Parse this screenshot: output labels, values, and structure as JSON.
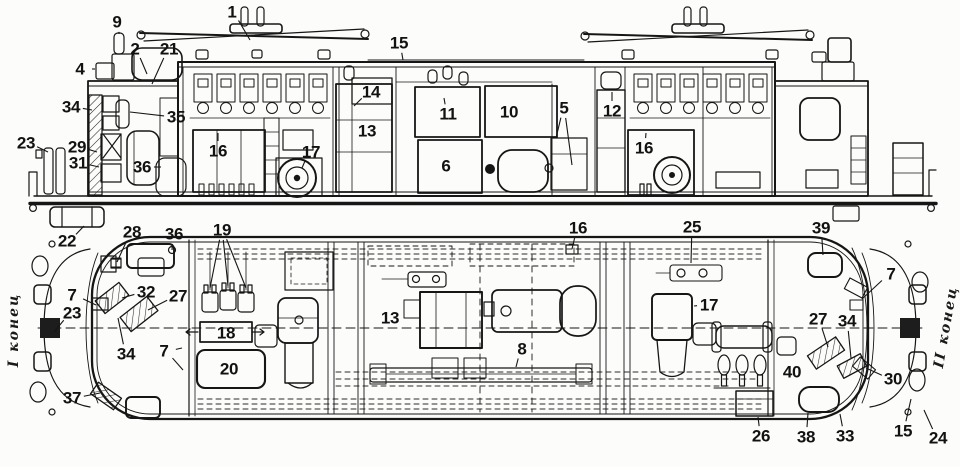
{
  "figure": {
    "end_label_left": "I конец",
    "end_label_right": "II конец"
  },
  "views": {
    "side": {
      "labels": [
        {
          "n": "1",
          "x": 232,
          "y": 12,
          "t": [
            [
              250,
              40
            ]
          ]
        },
        {
          "n": "9",
          "x": 117,
          "y": 22,
          "t": [
            [
              119,
              34
            ]
          ]
        },
        {
          "n": "2",
          "x": 135,
          "y": 49,
          "t": [
            [
              147,
              74
            ]
          ]
        },
        {
          "n": "21",
          "x": 169,
          "y": 49,
          "t": [
            [
              152,
              84
            ]
          ]
        },
        {
          "n": "4",
          "x": 80,
          "y": 69,
          "t": [
            [
              95,
              69
            ]
          ]
        },
        {
          "n": "15",
          "x": 399,
          "y": 43,
          "t": [
            [
              403,
              60
            ]
          ]
        },
        {
          "n": "34",
          "x": 71,
          "y": 107,
          "t": [
            [
              92,
              110
            ]
          ]
        },
        {
          "n": "35",
          "x": 176,
          "y": 117,
          "t": [
            [
              130,
              112
            ]
          ]
        },
        {
          "n": "23",
          "x": 26,
          "y": 143,
          "t": [
            [
              48,
              152
            ]
          ]
        },
        {
          "n": "29",
          "x": 77,
          "y": 147,
          "t": [
            [
              97,
              152
            ]
          ]
        },
        {
          "n": "31",
          "x": 78,
          "y": 163,
          "t": [
            [
              99,
              167
            ]
          ]
        },
        {
          "n": "36",
          "x": 142,
          "y": 167,
          "t": [
            [
              161,
              167
            ]
          ]
        },
        {
          "n": "16",
          "x": 218,
          "y": 151,
          "t": [
            [
              218,
              133
            ]
          ]
        },
        {
          "n": "17",
          "x": 311,
          "y": 152,
          "t": [
            [
              302,
              168
            ]
          ]
        },
        {
          "n": "14",
          "x": 371,
          "y": 92,
          "t": [
            [
              354,
              106
            ]
          ]
        },
        {
          "n": "13",
          "x": 367,
          "y": 131
        },
        {
          "n": "11",
          "x": 448,
          "y": 114,
          "t": [
            [
              444,
              98
            ]
          ]
        },
        {
          "n": "6",
          "x": 446,
          "y": 166
        },
        {
          "n": "10",
          "x": 509,
          "y": 112
        },
        {
          "n": "5",
          "x": 564,
          "y": 108,
          "t": [
            [
              556,
              138
            ],
            [
              572,
              165
            ]
          ]
        },
        {
          "n": "12",
          "x": 612,
          "y": 111,
          "t": [
            [
              612,
              92
            ]
          ]
        },
        {
          "n": "16",
          "x": 644,
          "y": 148,
          "t": [
            [
              646,
              133
            ]
          ]
        },
        {
          "n": "22",
          "x": 67,
          "y": 241,
          "t": [
            [
              84,
              226
            ]
          ]
        }
      ]
    },
    "plan": {
      "labels": [
        {
          "n": "28",
          "x": 132,
          "y": 232,
          "t": [
            [
              117,
              262
            ]
          ]
        },
        {
          "n": "36",
          "x": 174,
          "y": 234,
          "t": [
            [
              172,
              250
            ]
          ]
        },
        {
          "n": "19",
          "x": 222,
          "y": 230,
          "t": [
            [
              210,
              288
            ],
            [
              228,
              286
            ],
            [
              246,
              288
            ]
          ]
        },
        {
          "n": "7",
          "x": 72,
          "y": 295,
          "t": [
            [
              96,
              305
            ]
          ]
        },
        {
          "n": "23",
          "x": 72,
          "y": 313,
          "t": [
            [
              54,
              332
            ]
          ]
        },
        {
          "n": "32",
          "x": 146,
          "y": 292,
          "t": [
            [
              122,
              298
            ]
          ]
        },
        {
          "n": "27",
          "x": 178,
          "y": 296,
          "t": [
            [
              148,
              310
            ]
          ]
        },
        {
          "n": "34",
          "x": 126,
          "y": 354,
          "t": [
            [
              118,
              318
            ]
          ]
        },
        {
          "n": "7",
          "x": 164,
          "y": 351,
          "t": [
            [
              182,
              348
            ],
            [
              183,
              370
            ]
          ]
        },
        {
          "n": "37",
          "x": 72,
          "y": 398,
          "t": [
            [
              100,
              393
            ]
          ]
        },
        {
          "n": "18",
          "x": 226,
          "y": 333
        },
        {
          "n": "20",
          "x": 229,
          "y": 369
        },
        {
          "n": "13",
          "x": 390,
          "y": 318
        },
        {
          "n": "16",
          "x": 578,
          "y": 228,
          "t": [
            [
              572,
              249
            ]
          ]
        },
        {
          "n": "25",
          "x": 692,
          "y": 227,
          "t": [
            [
              691,
              263
            ]
          ]
        },
        {
          "n": "39",
          "x": 821,
          "y": 228,
          "t": [
            [
              823,
              255
            ]
          ]
        },
        {
          "n": "7",
          "x": 891,
          "y": 274,
          "t": [
            [
              862,
              299
            ]
          ]
        },
        {
          "n": "17",
          "x": 709,
          "y": 305,
          "t": [
            [
              694,
              306
            ]
          ]
        },
        {
          "n": "27",
          "x": 818,
          "y": 319,
          "t": [
            [
              828,
              347
            ]
          ]
        },
        {
          "n": "34",
          "x": 847,
          "y": 321,
          "t": [
            [
              851,
              358
            ]
          ]
        },
        {
          "n": "8",
          "x": 522,
          "y": 349,
          "t": [
            [
              516,
              367
            ]
          ]
        },
        {
          "n": "40",
          "x": 792,
          "y": 372
        },
        {
          "n": "30",
          "x": 893,
          "y": 379,
          "t": [
            [
              866,
              368
            ]
          ]
        },
        {
          "n": "26",
          "x": 761,
          "y": 436,
          "t": [
            [
              758,
              417
            ]
          ]
        },
        {
          "n": "38",
          "x": 806,
          "y": 437,
          "t": [
            [
              808,
              413
            ]
          ]
        },
        {
          "n": "33",
          "x": 845,
          "y": 436,
          "t": [
            [
              840,
              414
            ]
          ]
        },
        {
          "n": "15",
          "x": 903,
          "y": 431,
          "t": [
            [
              911,
              399
            ]
          ]
        },
        {
          "n": "24",
          "x": 938,
          "y": 438,
          "t": [
            [
              924,
              410
            ]
          ]
        }
      ]
    }
  }
}
